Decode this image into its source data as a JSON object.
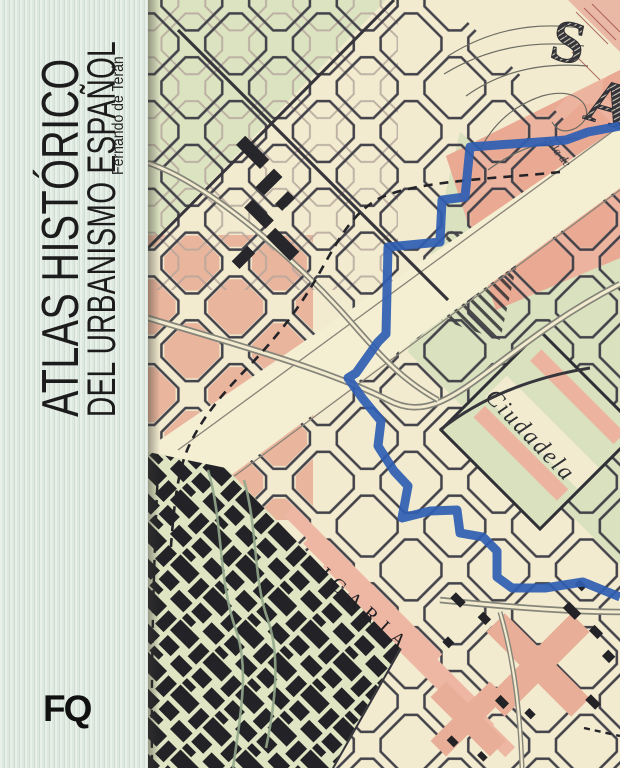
{
  "cover": {
    "title_line1": "ATLAS HISTÓRICO",
    "title_line2": "DEL URBANISMO ESPAÑOL",
    "author": "Fernando de Terán",
    "publisher_logo": "FQ"
  },
  "map": {
    "labels": {
      "park": "Ciudadela",
      "district": "ICARIA",
      "scale_note": "cala de",
      "ornament_letter_1": "S",
      "ornament_letter_2": "A"
    },
    "colors": {
      "band_mint": "#dde8e0",
      "paper_cream": "#f2ebcf",
      "block_green": "#dce3c1",
      "block_pink": "#ecb49e",
      "ink_dark": "#3a3a40",
      "route_blue": "#2f5fb3",
      "railway_grey": "#85857a"
    }
  }
}
